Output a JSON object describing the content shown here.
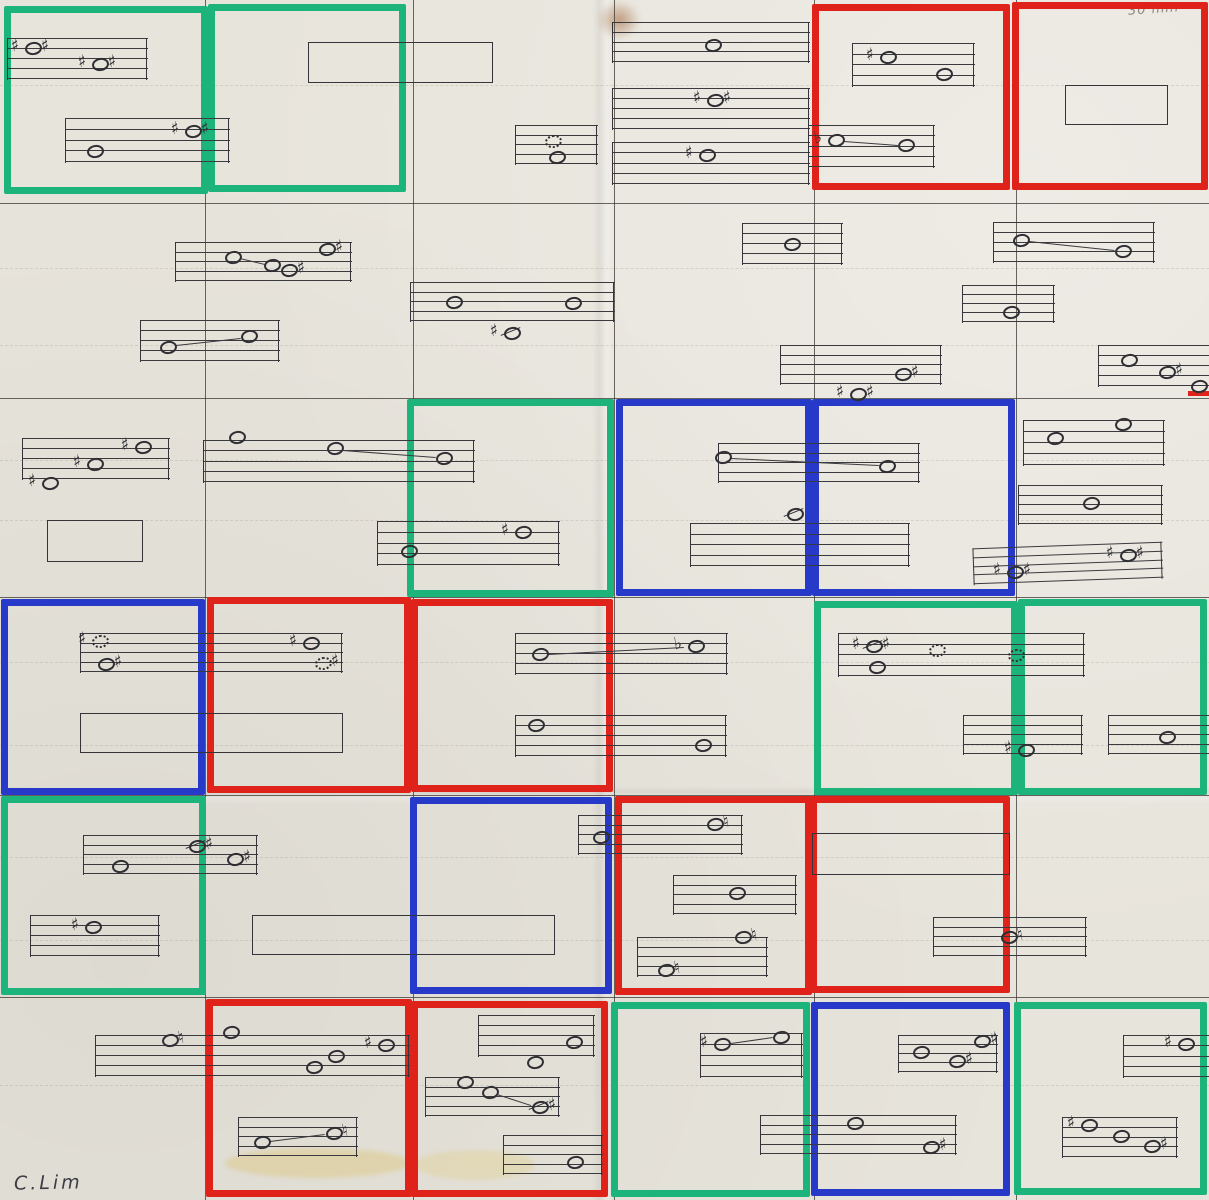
{
  "meta": {
    "title": "Hand-drawn graphic score grid, photographed paper"
  },
  "signature": {
    "text": "C.Lim"
  },
  "annotation": {
    "text": "30 min"
  },
  "palette": {
    "paper": "#e7e4db",
    "ink": "#34343a",
    "pencil": "#4a4741",
    "green": "#1db47c",
    "red": "#e0231a",
    "blue": "#2639c8"
  },
  "grid": {
    "h_lines": [
      203,
      398,
      597,
      795,
      997
    ],
    "v_lines": [
      205,
      413,
      614,
      814,
      1016
    ]
  },
  "faint_lines": [
    85,
    268,
    345,
    460,
    520,
    662,
    745,
    857,
    940,
    1085
  ],
  "cells": [
    {
      "row": 0,
      "col": 0,
      "x": 4,
      "y": 6,
      "w": 204,
      "h": 188,
      "color": "green"
    },
    {
      "row": 0,
      "col": 1,
      "x": 208,
      "y": 4,
      "w": 198,
      "h": 188,
      "color": "green"
    },
    {
      "row": 0,
      "col": 4,
      "x": 812,
      "y": 4,
      "w": 198,
      "h": 186,
      "color": "red"
    },
    {
      "row": 0,
      "col": 5,
      "x": 1012,
      "y": 2,
      "w": 196,
      "h": 188,
      "color": "red"
    },
    {
      "row": 2,
      "col": 2,
      "x": 407,
      "y": 399,
      "w": 207,
      "h": 198,
      "color": "green"
    },
    {
      "row": 2,
      "col": 3,
      "x": 616,
      "y": 399,
      "w": 196,
      "h": 197,
      "color": "blue"
    },
    {
      "row": 2,
      "col": 4,
      "x": 812,
      "y": 399,
      "w": 203,
      "h": 197,
      "color": "blue"
    },
    {
      "row": 3,
      "col": 0,
      "x": 1,
      "y": 599,
      "w": 204,
      "h": 196,
      "color": "blue"
    },
    {
      "row": 3,
      "col": 1,
      "x": 207,
      "y": 597,
      "w": 204,
      "h": 196,
      "color": "red"
    },
    {
      "row": 3,
      "col": 2,
      "x": 411,
      "y": 599,
      "w": 202,
      "h": 193,
      "color": "red"
    },
    {
      "row": 3,
      "col": 4,
      "x": 814,
      "y": 601,
      "w": 204,
      "h": 194,
      "color": "green"
    },
    {
      "row": 3,
      "col": 5,
      "x": 1018,
      "y": 599,
      "w": 189,
      "h": 196,
      "color": "green"
    },
    {
      "row": 4,
      "col": 0,
      "x": 1,
      "y": 796,
      "w": 205,
      "h": 199,
      "color": "green"
    },
    {
      "row": 4,
      "col": 2,
      "x": 410,
      "y": 797,
      "w": 202,
      "h": 197,
      "color": "blue"
    },
    {
      "row": 4,
      "col": 3,
      "x": 615,
      "y": 796,
      "w": 197,
      "h": 199,
      "color": "red"
    },
    {
      "row": 4,
      "col": 4,
      "x": 810,
      "y": 796,
      "w": 200,
      "h": 197,
      "color": "red"
    },
    {
      "row": 5,
      "col": 1,
      "x": 206,
      "y": 999,
      "w": 206,
      "h": 198,
      "color": "red"
    },
    {
      "row": 5,
      "col": 2,
      "x": 411,
      "y": 1001,
      "w": 197,
      "h": 196,
      "color": "red"
    },
    {
      "row": 5,
      "col": 3,
      "x": 611,
      "y": 1002,
      "w": 199,
      "h": 195,
      "color": "green"
    },
    {
      "row": 5,
      "col": 4,
      "x": 811,
      "y": 1002,
      "w": 199,
      "h": 194,
      "color": "blue"
    },
    {
      "row": 5,
      "col": 5,
      "x": 1014,
      "y": 1002,
      "w": 193,
      "h": 193,
      "color": "green"
    }
  ],
  "marker_segments": [
    {
      "x": 1188,
      "y": 391,
      "w": 21,
      "h": 5,
      "color": "red"
    }
  ],
  "rects": [
    {
      "x": 308,
      "y": 42,
      "w": 185,
      "h": 41
    },
    {
      "x": 1065,
      "y": 85,
      "w": 103,
      "h": 40
    },
    {
      "x": 47,
      "y": 520,
      "w": 96,
      "h": 42
    },
    {
      "x": 80,
      "y": 713,
      "w": 263,
      "h": 40
    },
    {
      "x": 252,
      "y": 915,
      "w": 303,
      "h": 40
    },
    {
      "x": 812,
      "y": 833,
      "w": 198,
      "h": 42
    }
  ],
  "staves": [
    {
      "x": 7,
      "y": 38,
      "w": 141,
      "h": 42
    },
    {
      "x": 65,
      "y": 118,
      "w": 165,
      "h": 45
    },
    {
      "x": 515,
      "y": 125,
      "w": 83,
      "h": 40
    },
    {
      "x": 612,
      "y": 22,
      "w": 198,
      "h": 41
    },
    {
      "x": 612,
      "y": 88,
      "w": 198,
      "h": 42
    },
    {
      "x": 612,
      "y": 142,
      "w": 198,
      "h": 43
    },
    {
      "x": 852,
      "y": 43,
      "w": 123,
      "h": 44
    },
    {
      "x": 808,
      "y": 125,
      "w": 127,
      "h": 43
    },
    {
      "x": 175,
      "y": 242,
      "w": 177,
      "h": 40
    },
    {
      "x": 140,
      "y": 320,
      "w": 140,
      "h": 42
    },
    {
      "x": 410,
      "y": 282,
      "w": 205,
      "h": 40
    },
    {
      "x": 742,
      "y": 223,
      "w": 101,
      "h": 42
    },
    {
      "x": 993,
      "y": 222,
      "w": 162,
      "h": 41
    },
    {
      "x": 962,
      "y": 285,
      "w": 93,
      "h": 38
    },
    {
      "x": 780,
      "y": 345,
      "w": 162,
      "h": 40
    },
    {
      "x": 1098,
      "y": 345,
      "w": 111,
      "h": 42,
      "edges": "left"
    },
    {
      "x": 22,
      "y": 438,
      "w": 148,
      "h": 42
    },
    {
      "x": 203,
      "y": 440,
      "w": 272,
      "h": 43
    },
    {
      "x": 377,
      "y": 521,
      "w": 183,
      "h": 45
    },
    {
      "x": 718,
      "y": 443,
      "w": 202,
      "h": 40
    },
    {
      "x": 690,
      "y": 523,
      "w": 220,
      "h": 44
    },
    {
      "x": 1023,
      "y": 420,
      "w": 142,
      "h": 46
    },
    {
      "x": 1018,
      "y": 485,
      "w": 145,
      "h": 40
    },
    {
      "x": 973,
      "y": 545,
      "w": 190,
      "h": 37,
      "rot": -2
    },
    {
      "x": 80,
      "y": 633,
      "w": 263,
      "h": 40
    },
    {
      "x": 515,
      "y": 633,
      "w": 213,
      "h": 42
    },
    {
      "x": 515,
      "y": 715,
      "w": 212,
      "h": 42
    },
    {
      "x": 838,
      "y": 633,
      "w": 247,
      "h": 44
    },
    {
      "x": 963,
      "y": 715,
      "w": 120,
      "h": 40
    },
    {
      "x": 1108,
      "y": 715,
      "w": 101,
      "h": 40,
      "edges": "left"
    },
    {
      "x": 83,
      "y": 835,
      "w": 175,
      "h": 40
    },
    {
      "x": 30,
      "y": 915,
      "w": 130,
      "h": 42
    },
    {
      "x": 578,
      "y": 815,
      "w": 165,
      "h": 40
    },
    {
      "x": 673,
      "y": 875,
      "w": 124,
      "h": 40
    },
    {
      "x": 637,
      "y": 937,
      "w": 131,
      "h": 40
    },
    {
      "x": 933,
      "y": 917,
      "w": 154,
      "h": 40
    },
    {
      "x": 95,
      "y": 1035,
      "w": 315,
      "h": 42
    },
    {
      "x": 238,
      "y": 1117,
      "w": 120,
      "h": 40
    },
    {
      "x": 478,
      "y": 1015,
      "w": 117,
      "h": 42
    },
    {
      "x": 425,
      "y": 1077,
      "w": 135,
      "h": 40
    },
    {
      "x": 503,
      "y": 1135,
      "w": 100,
      "h": 40
    },
    {
      "x": 700,
      "y": 1033,
      "w": 103,
      "h": 45
    },
    {
      "x": 760,
      "y": 1115,
      "w": 197,
      "h": 40
    },
    {
      "x": 898,
      "y": 1035,
      "w": 100,
      "h": 38
    },
    {
      "x": 1123,
      "y": 1035,
      "w": 86,
      "h": 43,
      "edges": "left"
    },
    {
      "x": 1062,
      "y": 1117,
      "w": 116,
      "h": 41
    }
  ],
  "notes": [
    {
      "x": 33,
      "y": 48,
      "head": "o",
      "pre": "♯",
      "post": "♯"
    },
    {
      "x": 100,
      "y": 64,
      "head": "o",
      "pre": "♯",
      "post": "♯"
    },
    {
      "x": 193,
      "y": 131,
      "head": "o",
      "pre": "♯",
      "post": "♯"
    },
    {
      "x": 95,
      "y": 151,
      "head": "o",
      "pre": "",
      "post": ""
    },
    {
      "x": 553,
      "y": 141,
      "head": "dot",
      "pre": "",
      "post": ""
    },
    {
      "x": 557,
      "y": 157,
      "head": "o",
      "pre": "",
      "post": ""
    },
    {
      "x": 713,
      "y": 45,
      "head": "o",
      "pre": "",
      "post": ""
    },
    {
      "x": 715,
      "y": 100,
      "head": "o",
      "pre": "♯",
      "post": "♯"
    },
    {
      "x": 707,
      "y": 155,
      "head": "o",
      "pre": "♯",
      "post": ""
    },
    {
      "x": 888,
      "y": 57,
      "head": "o",
      "pre": "♯",
      "post": ""
    },
    {
      "x": 944,
      "y": 74,
      "head": "o",
      "pre": "",
      "post": ""
    },
    {
      "x": 836,
      "y": 140,
      "head": "o",
      "pre": "♭",
      "post": ""
    },
    {
      "x": 906,
      "y": 145,
      "head": "o",
      "pre": "",
      "post": ""
    },
    {
      "x": 233,
      "y": 257,
      "head": "o",
      "pre": "",
      "post": ""
    },
    {
      "x": 272,
      "y": 265,
      "head": "o",
      "pre": "",
      "post": ""
    },
    {
      "x": 289,
      "y": 270,
      "head": "o",
      "pre": "",
      "post": "♯"
    },
    {
      "x": 327,
      "y": 249,
      "head": "o",
      "pre": "",
      "post": "♯"
    },
    {
      "x": 168,
      "y": 347,
      "head": "o",
      "pre": "",
      "post": ""
    },
    {
      "x": 249,
      "y": 336,
      "head": "o",
      "pre": "",
      "post": ""
    },
    {
      "x": 454,
      "y": 302,
      "head": "o",
      "pre": "",
      "post": ""
    },
    {
      "x": 573,
      "y": 303,
      "head": "o",
      "pre": "",
      "post": ""
    },
    {
      "x": 512,
      "y": 333,
      "head": "slash",
      "pre": "♯",
      "post": ""
    },
    {
      "x": 792,
      "y": 244,
      "head": "o",
      "pre": "",
      "post": ""
    },
    {
      "x": 1021,
      "y": 240,
      "head": "o",
      "pre": "",
      "post": ""
    },
    {
      "x": 1123,
      "y": 251,
      "head": "o",
      "pre": "",
      "post": ""
    },
    {
      "x": 1011,
      "y": 312,
      "head": "o",
      "pre": "",
      "post": ""
    },
    {
      "x": 903,
      "y": 374,
      "head": "o",
      "pre": "",
      "post": "♯"
    },
    {
      "x": 858,
      "y": 394,
      "head": "o",
      "pre": "♯",
      "post": "♯"
    },
    {
      "x": 1129,
      "y": 360,
      "head": "o",
      "pre": "",
      "post": ""
    },
    {
      "x": 1167,
      "y": 372,
      "head": "o",
      "pre": "",
      "post": "♯"
    },
    {
      "x": 1199,
      "y": 386,
      "head": "o",
      "pre": "",
      "post": ""
    },
    {
      "x": 143,
      "y": 447,
      "head": "o",
      "pre": "♯",
      "post": ""
    },
    {
      "x": 95,
      "y": 464,
      "head": "o",
      "pre": "♯",
      "post": ""
    },
    {
      "x": 50,
      "y": 483,
      "head": "o",
      "pre": "♯",
      "post": ""
    },
    {
      "x": 237,
      "y": 437,
      "head": "o",
      "pre": "",
      "post": ""
    },
    {
      "x": 335,
      "y": 448,
      "head": "o",
      "pre": "",
      "post": ""
    },
    {
      "x": 444,
      "y": 458,
      "head": "o",
      "pre": "",
      "post": ""
    },
    {
      "x": 409,
      "y": 551,
      "head": "o",
      "pre": "",
      "post": ""
    },
    {
      "x": 523,
      "y": 532,
      "head": "o",
      "pre": "♯",
      "post": ""
    },
    {
      "x": 723,
      "y": 457,
      "head": "o",
      "pre": "",
      "post": ""
    },
    {
      "x": 887,
      "y": 466,
      "head": "o",
      "pre": "",
      "post": ""
    },
    {
      "x": 795,
      "y": 514,
      "head": "slash",
      "pre": "",
      "post": ""
    },
    {
      "x": 1055,
      "y": 438,
      "head": "o",
      "pre": "",
      "post": ""
    },
    {
      "x": 1123,
      "y": 424,
      "head": "o",
      "pre": "",
      "post": ""
    },
    {
      "x": 1091,
      "y": 503,
      "head": "o",
      "pre": "",
      "post": ""
    },
    {
      "x": 1128,
      "y": 555,
      "head": "o",
      "pre": "♯",
      "post": "♯"
    },
    {
      "x": 1015,
      "y": 572,
      "head": "o",
      "pre": "♯",
      "post": "♯"
    },
    {
      "x": 100,
      "y": 641,
      "head": "dot",
      "pre": "♯",
      "post": ""
    },
    {
      "x": 106,
      "y": 664,
      "head": "o",
      "pre": "",
      "post": "♯"
    },
    {
      "x": 311,
      "y": 643,
      "head": "o",
      "pre": "♯",
      "post": ""
    },
    {
      "x": 323,
      "y": 663,
      "head": "dot",
      "pre": "",
      "post": "♯"
    },
    {
      "x": 540,
      "y": 654,
      "head": "o",
      "pre": "",
      "post": ""
    },
    {
      "x": 696,
      "y": 646,
      "head": "o",
      "pre": "♭",
      "post": ""
    },
    {
      "x": 536,
      "y": 725,
      "head": "o",
      "pre": "",
      "post": ""
    },
    {
      "x": 703,
      "y": 745,
      "head": "o",
      "pre": "",
      "post": ""
    },
    {
      "x": 874,
      "y": 646,
      "head": "slash",
      "pre": "♯",
      "post": "♯"
    },
    {
      "x": 877,
      "y": 667,
      "head": "o",
      "pre": "",
      "post": ""
    },
    {
      "x": 937,
      "y": 650,
      "head": "dot",
      "pre": "",
      "post": ""
    },
    {
      "x": 1016,
      "y": 655,
      "head": "dot",
      "pre": "",
      "post": ""
    },
    {
      "x": 1026,
      "y": 750,
      "head": "o",
      "pre": "♯",
      "post": ""
    },
    {
      "x": 1167,
      "y": 737,
      "head": "o",
      "pre": "",
      "post": ""
    },
    {
      "x": 197,
      "y": 846,
      "head": "slash",
      "pre": "",
      "post": "♯"
    },
    {
      "x": 235,
      "y": 859,
      "head": "o",
      "pre": "",
      "post": "♯"
    },
    {
      "x": 120,
      "y": 866,
      "head": "o",
      "pre": "",
      "post": ""
    },
    {
      "x": 93,
      "y": 927,
      "head": "o",
      "pre": "♯",
      "post": ""
    },
    {
      "x": 601,
      "y": 837,
      "head": "o",
      "pre": "",
      "post": ""
    },
    {
      "x": 715,
      "y": 824,
      "head": "o",
      "pre": "",
      "post": "♮"
    },
    {
      "x": 737,
      "y": 893,
      "head": "o",
      "pre": "",
      "post": ""
    },
    {
      "x": 743,
      "y": 937,
      "head": "o",
      "pre": "",
      "post": "♮"
    },
    {
      "x": 666,
      "y": 970,
      "head": "o",
      "pre": "",
      "post": "♮"
    },
    {
      "x": 1009,
      "y": 937,
      "head": "o",
      "pre": "",
      "post": "♮"
    },
    {
      "x": 170,
      "y": 1040,
      "head": "o",
      "pre": "",
      "post": "♮"
    },
    {
      "x": 231,
      "y": 1032,
      "head": "o",
      "pre": "",
      "post": ""
    },
    {
      "x": 314,
      "y": 1067,
      "head": "o",
      "pre": "",
      "post": ""
    },
    {
      "x": 336,
      "y": 1056,
      "head": "o",
      "pre": "",
      "post": ""
    },
    {
      "x": 386,
      "y": 1045,
      "head": "o",
      "pre": "♯",
      "post": ""
    },
    {
      "x": 262,
      "y": 1142,
      "head": "o",
      "pre": "",
      "post": ""
    },
    {
      "x": 334,
      "y": 1133,
      "head": "o",
      "pre": "",
      "post": "♮"
    },
    {
      "x": 574,
      "y": 1042,
      "head": "o",
      "pre": "",
      "post": ""
    },
    {
      "x": 535,
      "y": 1062,
      "head": "o",
      "pre": "",
      "post": ""
    },
    {
      "x": 465,
      "y": 1082,
      "head": "o",
      "pre": "",
      "post": ""
    },
    {
      "x": 490,
      "y": 1092,
      "head": "o",
      "pre": "",
      "post": ""
    },
    {
      "x": 540,
      "y": 1107,
      "head": "slash",
      "pre": "",
      "post": "♯"
    },
    {
      "x": 575,
      "y": 1162,
      "head": "o",
      "pre": "",
      "post": ""
    },
    {
      "x": 722,
      "y": 1044,
      "head": "o",
      "pre": "♯",
      "post": ""
    },
    {
      "x": 781,
      "y": 1037,
      "head": "o",
      "pre": "",
      "post": ""
    },
    {
      "x": 855,
      "y": 1123,
      "head": "o",
      "pre": "",
      "post": ""
    },
    {
      "x": 931,
      "y": 1147,
      "head": "o",
      "pre": "",
      "post": "♯"
    },
    {
      "x": 921,
      "y": 1052,
      "head": "o",
      "pre": "",
      "post": ""
    },
    {
      "x": 957,
      "y": 1061,
      "head": "o",
      "pre": "",
      "post": "♯"
    },
    {
      "x": 982,
      "y": 1041,
      "head": "o",
      "pre": "",
      "post": "♯"
    },
    {
      "x": 1186,
      "y": 1044,
      "head": "o",
      "pre": "♯",
      "post": ""
    },
    {
      "x": 1089,
      "y": 1125,
      "head": "o",
      "pre": "♯",
      "post": ""
    },
    {
      "x": 1121,
      "y": 1136,
      "head": "o",
      "pre": "",
      "post": ""
    },
    {
      "x": 1152,
      "y": 1146,
      "head": "o",
      "pre": "",
      "post": "♯"
    }
  ],
  "connector_lines": [
    {
      "x1": 844,
      "y1": 141,
      "x2": 898,
      "y2": 145
    },
    {
      "x1": 240,
      "y1": 258,
      "x2": 265,
      "y2": 264
    },
    {
      "x1": 176,
      "y1": 345,
      "x2": 241,
      "y2": 338
    },
    {
      "x1": 1029,
      "y1": 241,
      "x2": 1115,
      "y2": 250
    },
    {
      "x1": 343,
      "y1": 450,
      "x2": 436,
      "y2": 457
    },
    {
      "x1": 731,
      "y1": 458,
      "x2": 879,
      "y2": 465
    },
    {
      "x1": 548,
      "y1": 654,
      "x2": 684,
      "y2": 647
    },
    {
      "x1": 270,
      "y1": 1141,
      "x2": 325,
      "y2": 1134
    },
    {
      "x1": 497,
      "y1": 1094,
      "x2": 531,
      "y2": 1105
    },
    {
      "x1": 731,
      "y1": 1043,
      "x2": 773,
      "y2": 1037
    }
  ]
}
